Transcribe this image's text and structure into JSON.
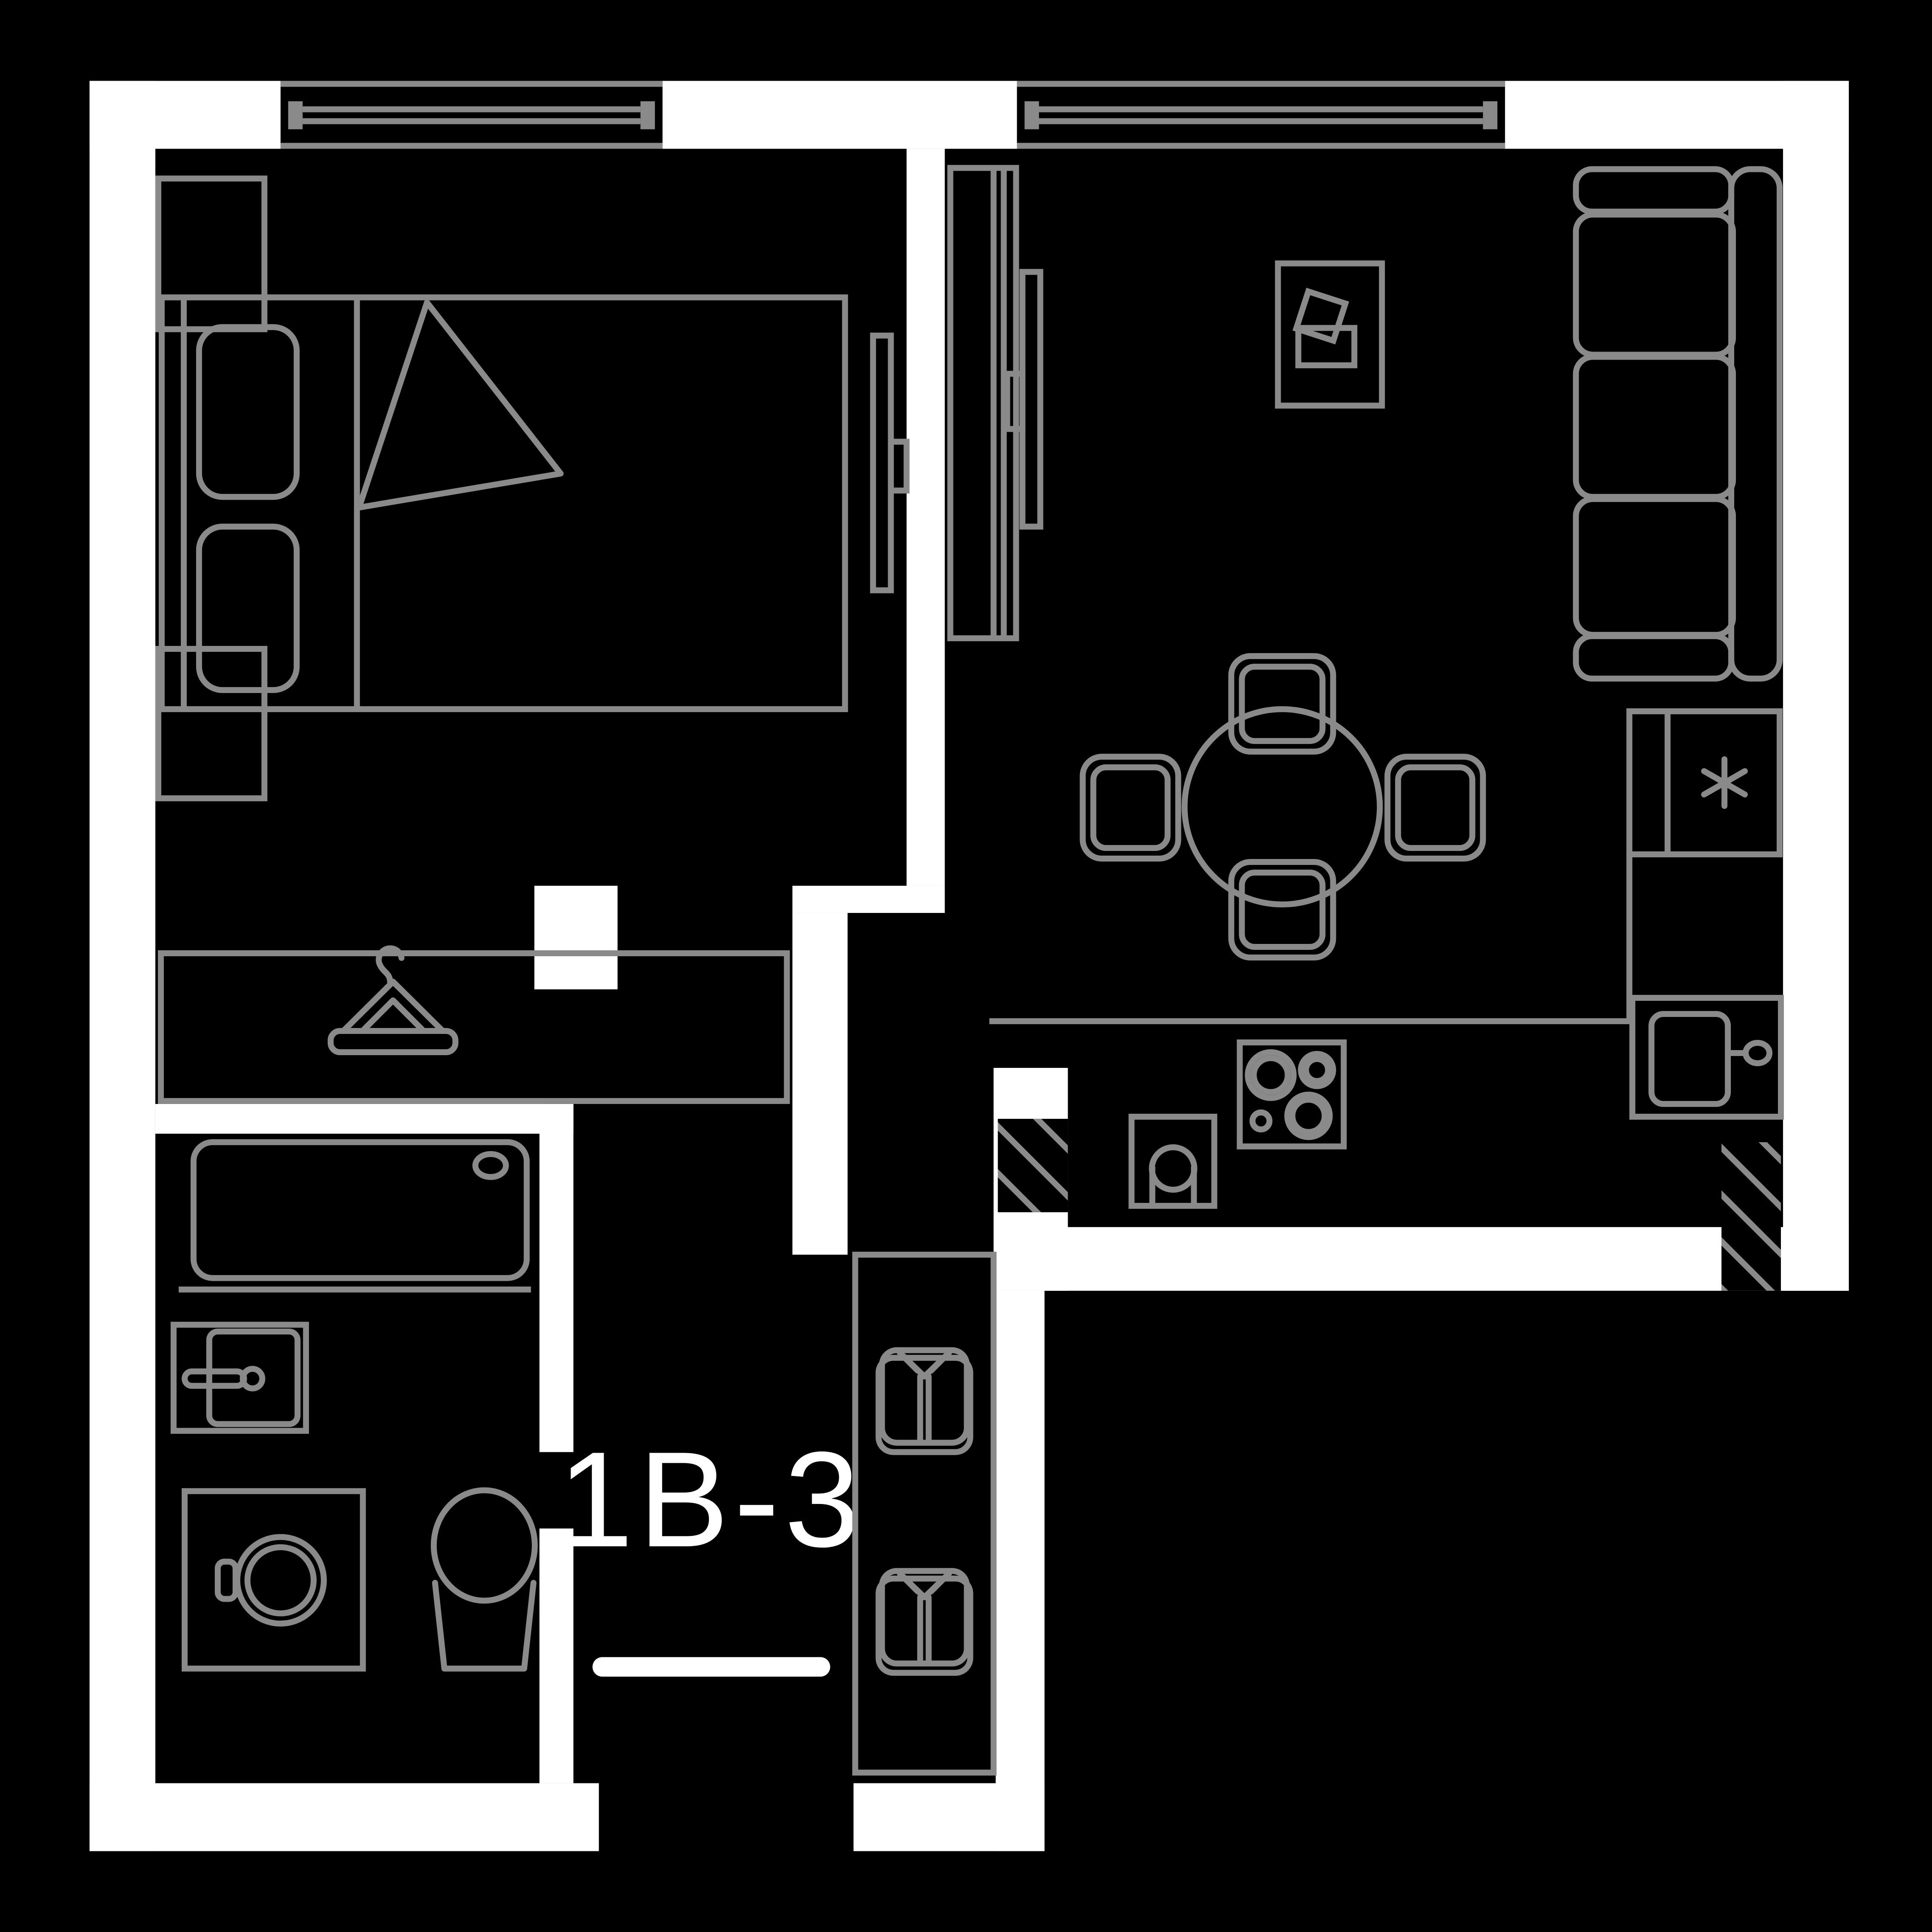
{
  "unit": {
    "label": "1B-3"
  },
  "palette": {
    "background": "#000000",
    "wall": "#ffffff",
    "line": "#8a8a8a",
    "text": "#ffffff"
  },
  "icons": [
    "window-icon",
    "double-bed-icon",
    "pillow-icon",
    "blanket-fold-icon",
    "nightstand-icon",
    "tv-icon",
    "tv-cabinet-icon",
    "coffee-table-icon",
    "sofa-icon",
    "dining-table-icon",
    "chair-icon",
    "refrigerator-asterisk-icon",
    "kitchen-sink-icon",
    "oven-icon",
    "cooktop-icon",
    "ventilation-shaft-hatch-icon",
    "clothes-hanger-icon",
    "bathtub-icon",
    "washbasin-icon",
    "washing-machine-icon",
    "toilet-icon",
    "folded-shirt-icon"
  ]
}
